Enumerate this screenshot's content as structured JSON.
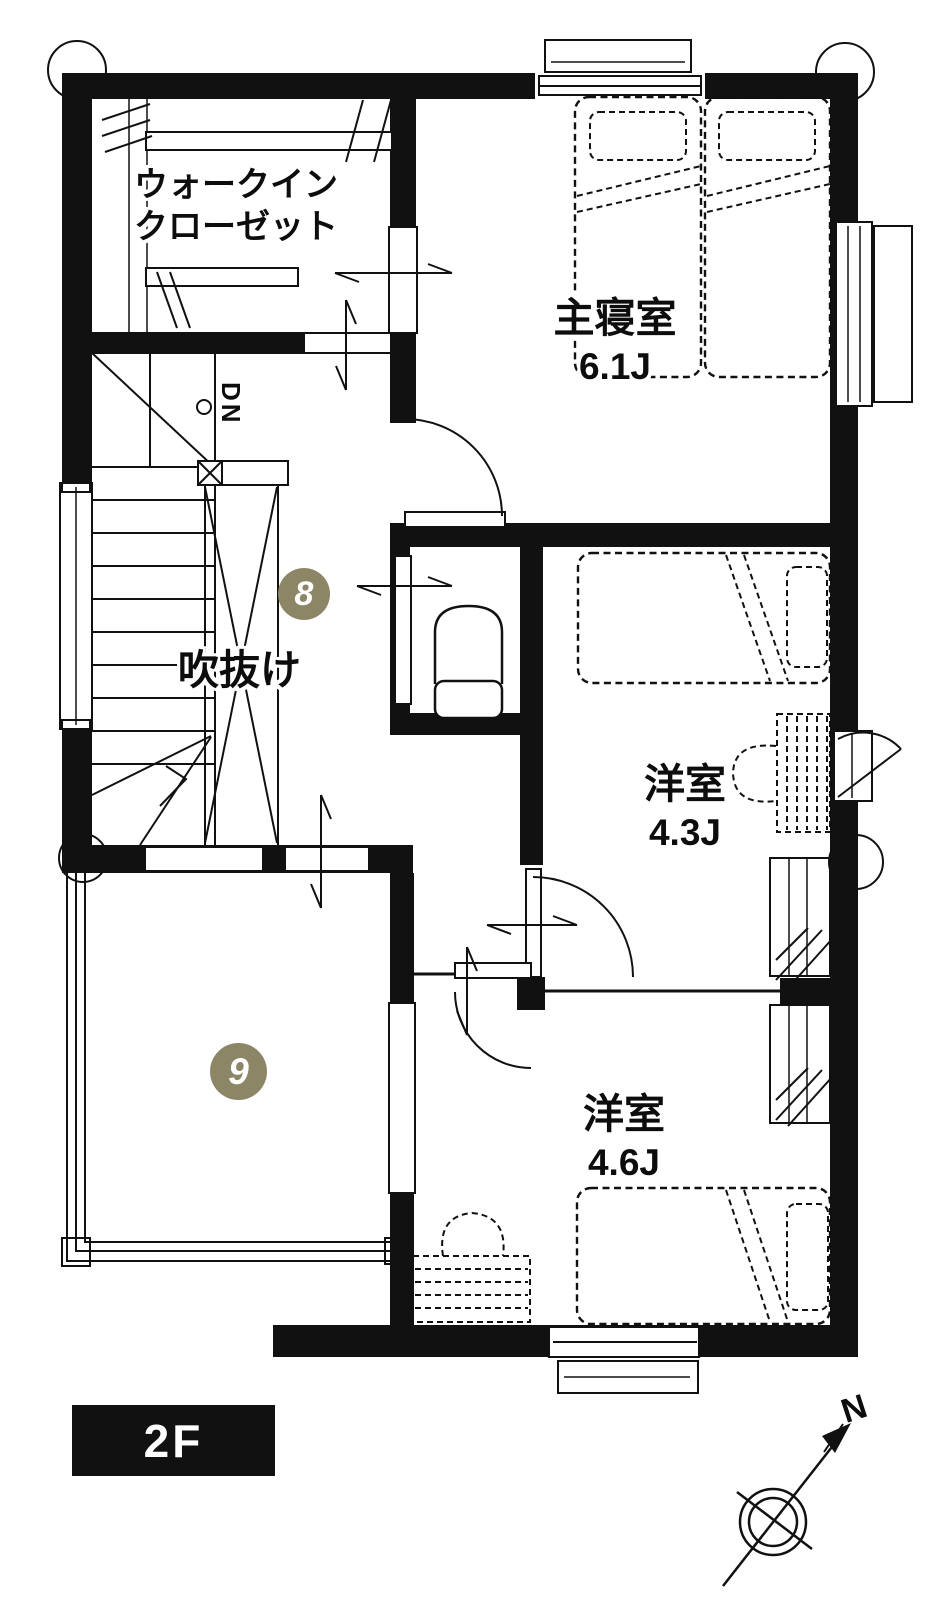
{
  "plan": {
    "floor_label": "2F",
    "compass_north_label": "N",
    "stairs_label": "DN",
    "rooms": {
      "walk_in_closet": {
        "name_line1": "ウォークイン",
        "name_line2": "クローゼット"
      },
      "master_bedroom": {
        "name": "主寝室",
        "size": "6.1J"
      },
      "void_space": {
        "name": "吹抜け"
      },
      "western_room_4_3": {
        "name": "洋室",
        "size": "4.3J"
      },
      "western_room_4_6": {
        "name": "洋室",
        "size": "4.6J"
      }
    },
    "markers": [
      {
        "number": "8"
      },
      {
        "number": "9"
      }
    ],
    "colors": {
      "wall": "#111111",
      "marker_fill": "#8C8667",
      "marker_text": "#ffffff",
      "floor_badge_bg": "#111111",
      "floor_badge_text": "#ffffff"
    }
  }
}
